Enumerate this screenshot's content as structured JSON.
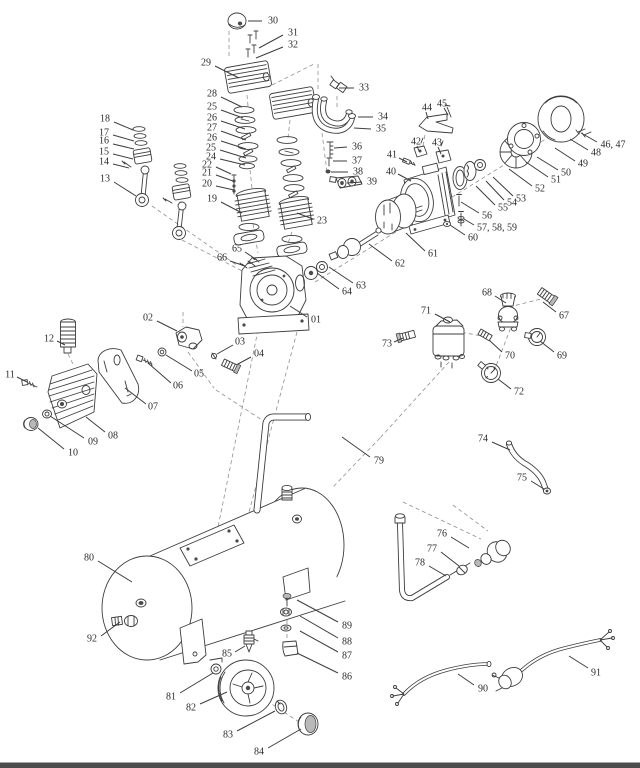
{
  "diagram": {
    "subject": "Air compressor exploded parts diagram",
    "background_color": "#ffffff",
    "line_color": "#3d3d3d",
    "dashed_line_color": "#8f8f8f",
    "label_color": "#2b2b2b",
    "footer_bar_color": "#4c4c4c",
    "label_font_size": 10,
    "callouts": [
      {
        "label": "30",
        "x": 273,
        "y": 21,
        "x1": 262,
        "y1": 21,
        "x2": 248,
        "y2": 21
      },
      {
        "label": "31",
        "x": 293,
        "y": 33,
        "x1": 283,
        "y1": 35,
        "x2": 259,
        "y2": 48
      },
      {
        "label": "32",
        "x": 293,
        "y": 45,
        "x1": 283,
        "y1": 47,
        "x2": 256,
        "y2": 58
      },
      {
        "label": "29",
        "x": 206,
        "y": 63,
        "x1": 215,
        "y1": 66,
        "x2": 239,
        "y2": 78
      },
      {
        "label": "33",
        "x": 364,
        "y": 88,
        "x1": 354,
        "y1": 88,
        "x2": 339,
        "y2": 88
      },
      {
        "label": "34",
        "x": 383,
        "y": 117,
        "x1": 373,
        "y1": 117,
        "x2": 358,
        "y2": 117
      },
      {
        "label": "35",
        "x": 381,
        "y": 129,
        "x1": 371,
        "y1": 129,
        "x2": 354,
        "y2": 128
      },
      {
        "label": "28",
        "x": 212,
        "y": 94,
        "x1": 221,
        "y1": 97,
        "x2": 242,
        "y2": 107
      },
      {
        "label": "25",
        "x": 212,
        "y": 107,
        "x1": 221,
        "y1": 110,
        "x2": 243,
        "y2": 118
      },
      {
        "label": "26",
        "x": 212,
        "y": 118,
        "x1": 221,
        "y1": 121,
        "x2": 245,
        "y2": 129
      },
      {
        "label": "27",
        "x": 212,
        "y": 128,
        "x1": 221,
        "y1": 131,
        "x2": 246,
        "y2": 140
      },
      {
        "label": "26",
        "x": 212,
        "y": 138,
        "x1": 221,
        "y1": 141,
        "x2": 246,
        "y2": 149
      },
      {
        "label": "25",
        "x": 211,
        "y": 148,
        "x1": 220,
        "y1": 150,
        "x2": 246,
        "y2": 158
      },
      {
        "label": "24",
        "x": 211,
        "y": 157,
        "x1": 220,
        "y1": 159,
        "x2": 245,
        "y2": 165
      },
      {
        "label": "22",
        "x": 207,
        "y": 165,
        "x1": 216,
        "y1": 167,
        "x2": 231,
        "y2": 174
      },
      {
        "label": "21",
        "x": 207,
        "y": 173,
        "x1": 216,
        "y1": 175,
        "x2": 233,
        "y2": 181
      },
      {
        "label": "20",
        "x": 207,
        "y": 184,
        "x1": 216,
        "y1": 186,
        "x2": 234,
        "y2": 190
      },
      {
        "label": "19",
        "x": 212,
        "y": 199,
        "x1": 221,
        "y1": 202,
        "x2": 242,
        "y2": 213
      },
      {
        "label": "18",
        "x": 105,
        "y": 119,
        "x1": 114,
        "y1": 122,
        "x2": 133,
        "y2": 130
      },
      {
        "label": "17",
        "x": 104,
        "y": 133,
        "x1": 113,
        "y1": 135,
        "x2": 134,
        "y2": 141
      },
      {
        "label": "16",
        "x": 104,
        "y": 141,
        "x1": 113,
        "y1": 144,
        "x2": 134,
        "y2": 149
      },
      {
        "label": "15",
        "x": 104,
        "y": 152,
        "x1": 113,
        "y1": 154,
        "x2": 133,
        "y2": 159
      },
      {
        "label": "14",
        "x": 104,
        "y": 162,
        "x1": 113,
        "y1": 164,
        "x2": 129,
        "y2": 168
      },
      {
        "label": "13",
        "x": 105,
        "y": 179,
        "x1": 114,
        "y1": 182,
        "x2": 136,
        "y2": 196
      },
      {
        "label": "23",
        "x": 322,
        "y": 221,
        "x1": 313,
        "y1": 219,
        "x2": 297,
        "y2": 213
      },
      {
        "label": "36",
        "x": 357,
        "y": 147,
        "x1": 347,
        "y1": 147,
        "x2": 334,
        "y2": 148
      },
      {
        "label": "37",
        "x": 357,
        "y": 161,
        "x1": 347,
        "y1": 161,
        "x2": 333,
        "y2": 161
      },
      {
        "label": "38",
        "x": 358,
        "y": 172,
        "x1": 348,
        "y1": 172,
        "x2": 331,
        "y2": 172
      },
      {
        "label": "39",
        "x": 372,
        "y": 182,
        "x1": 362,
        "y1": 182,
        "x2": 347,
        "y2": 183
      },
      {
        "label": "44",
        "x": 427,
        "y": 108,
        "x1": 426,
        "y1": 112,
        "x2": 428,
        "y2": 119
      },
      {
        "label": "45",
        "x": 442,
        "y": 104,
        "x1": 444,
        "y1": 108,
        "x2": 448,
        "y2": 115
      },
      {
        "label": "42",
        "x": 416,
        "y": 142,
        "x1": 417,
        "y1": 146,
        "x2": 419,
        "y2": 151
      },
      {
        "label": "43",
        "x": 437,
        "y": 143,
        "x1": 438,
        "y1": 147,
        "x2": 441,
        "y2": 154
      },
      {
        "label": "41",
        "x": 392,
        "y": 155,
        "x1": 399,
        "y1": 158,
        "x2": 407,
        "y2": 162
      },
      {
        "label": "40",
        "x": 391,
        "y": 172,
        "x1": 398,
        "y1": 174,
        "x2": 411,
        "y2": 181
      },
      {
        "label": "46, 47",
        "x": 613,
        "y": 145,
        "x1": 597,
        "y1": 142,
        "x2": 581,
        "y2": 133
      },
      {
        "label": "48",
        "x": 596,
        "y": 153,
        "x1": 588,
        "y1": 150,
        "x2": 570,
        "y2": 139
      },
      {
        "label": "49",
        "x": 583,
        "y": 164,
        "x1": 575,
        "y1": 161,
        "x2": 555,
        "y2": 148
      },
      {
        "label": "50",
        "x": 566,
        "y": 173,
        "x1": 558,
        "y1": 170,
        "x2": 537,
        "y2": 157
      },
      {
        "label": "51",
        "x": 556,
        "y": 180,
        "x1": 548,
        "y1": 177,
        "x2": 526,
        "y2": 162
      },
      {
        "label": "52",
        "x": 540,
        "y": 189,
        "x1": 532,
        "y1": 186,
        "x2": 509,
        "y2": 169
      },
      {
        "label": "53",
        "x": 521,
        "y": 199,
        "x1": 513,
        "y1": 196,
        "x2": 493,
        "y2": 177
      },
      {
        "label": "54",
        "x": 512,
        "y": 203,
        "x1": 504,
        "y1": 200,
        "x2": 486,
        "y2": 181
      },
      {
        "label": "55",
        "x": 503,
        "y": 208,
        "x1": 495,
        "y1": 205,
        "x2": 476,
        "y2": 186
      },
      {
        "label": "56",
        "x": 487,
        "y": 216,
        "x1": 479,
        "y1": 213,
        "x2": 461,
        "y2": 202
      },
      {
        "label": "57, 58, 59",
        "x": 497,
        "y": 228,
        "x1": 474,
        "y1": 225,
        "x2": 464,
        "y2": 219
      },
      {
        "label": "60",
        "x": 473,
        "y": 238,
        "x1": 465,
        "y1": 235,
        "x2": 450,
        "y2": 225
      },
      {
        "label": "61",
        "x": 433,
        "y": 254,
        "x1": 425,
        "y1": 251,
        "x2": 406,
        "y2": 233
      },
      {
        "label": "62",
        "x": 400,
        "y": 264,
        "x1": 392,
        "y1": 261,
        "x2": 369,
        "y2": 244
      },
      {
        "label": "63",
        "x": 361,
        "y": 286,
        "x1": 353,
        "y1": 283,
        "x2": 329,
        "y2": 267
      },
      {
        "label": "64",
        "x": 347,
        "y": 292,
        "x1": 339,
        "y1": 289,
        "x2": 317,
        "y2": 273
      },
      {
        "label": "65",
        "x": 237,
        "y": 249,
        "x1": 245,
        "y1": 252,
        "x2": 257,
        "y2": 260
      },
      {
        "label": "66",
        "x": 222,
        "y": 258,
        "x1": 230,
        "y1": 261,
        "x2": 245,
        "y2": 266
      },
      {
        "label": "01",
        "x": 316,
        "y": 320,
        "x1": 307,
        "y1": 317,
        "x2": 290,
        "y2": 306
      },
      {
        "label": "02",
        "x": 148,
        "y": 318,
        "x1": 157,
        "y1": 321,
        "x2": 177,
        "y2": 331
      },
      {
        "label": "03",
        "x": 240,
        "y": 342,
        "x1": 233,
        "y1": 345,
        "x2": 217,
        "y2": 354
      },
      {
        "label": "04",
        "x": 259,
        "y": 354,
        "x1": 251,
        "y1": 357,
        "x2": 238,
        "y2": 364
      },
      {
        "label": "05",
        "x": 199,
        "y": 374,
        "x1": 192,
        "y1": 371,
        "x2": 166,
        "y2": 355
      },
      {
        "label": "06",
        "x": 178,
        "y": 386,
        "x1": 171,
        "y1": 383,
        "x2": 148,
        "y2": 363
      },
      {
        "label": "07",
        "x": 153,
        "y": 407,
        "x1": 146,
        "y1": 404,
        "x2": 125,
        "y2": 388
      },
      {
        "label": "08",
        "x": 113,
        "y": 436,
        "x1": 105,
        "y1": 432,
        "x2": 86,
        "y2": 417
      },
      {
        "label": "09",
        "x": 93,
        "y": 442,
        "x1": 84,
        "y1": 438,
        "x2": 50,
        "y2": 416
      },
      {
        "label": "10",
        "x": 73,
        "y": 453,
        "x1": 64,
        "y1": 449,
        "x2": 38,
        "y2": 428
      },
      {
        "label": "11",
        "x": 10,
        "y": 375,
        "x1": 17,
        "y1": 377,
        "x2": 27,
        "y2": 382
      },
      {
        "label": "12",
        "x": 49,
        "y": 339,
        "x1": 57,
        "y1": 341,
        "x2": 65,
        "y2": 345
      },
      {
        "label": "67",
        "x": 564,
        "y": 316,
        "x1": 556,
        "y1": 312,
        "x2": 543,
        "y2": 302
      },
      {
        "label": "68",
        "x": 487,
        "y": 293,
        "x1": 495,
        "y1": 296,
        "x2": 506,
        "y2": 303
      },
      {
        "label": "69",
        "x": 562,
        "y": 356,
        "x1": 554,
        "y1": 352,
        "x2": 540,
        "y2": 341
      },
      {
        "label": "70",
        "x": 510,
        "y": 356,
        "x1": 502,
        "y1": 352,
        "x2": 489,
        "y2": 340
      },
      {
        "label": "71",
        "x": 426,
        "y": 311,
        "x1": 435,
        "y1": 314,
        "x2": 450,
        "y2": 322
      },
      {
        "label": "72",
        "x": 519,
        "y": 392,
        "x1": 511,
        "y1": 389,
        "x2": 498,
        "y2": 379
      },
      {
        "label": "73",
        "x": 387,
        "y": 344,
        "x1": 394,
        "y1": 342,
        "x2": 403,
        "y2": 338
      },
      {
        "label": "74",
        "x": 483,
        "y": 439,
        "x1": 492,
        "y1": 442,
        "x2": 510,
        "y2": 450
      },
      {
        "label": "75",
        "x": 522,
        "y": 478,
        "x1": 531,
        "y1": 481,
        "x2": 544,
        "y2": 489
      },
      {
        "label": "76",
        "x": 442,
        "y": 534,
        "x1": 451,
        "y1": 537,
        "x2": 469,
        "y2": 548
      },
      {
        "label": "77",
        "x": 432,
        "y": 549,
        "x1": 441,
        "y1": 552,
        "x2": 459,
        "y2": 566
      },
      {
        "label": "78",
        "x": 420,
        "y": 563,
        "x1": 429,
        "y1": 566,
        "x2": 446,
        "y2": 576
      },
      {
        "label": "79",
        "x": 379,
        "y": 461,
        "x1": 370,
        "y1": 457,
        "x2": 342,
        "y2": 437
      },
      {
        "label": "80",
        "x": 89,
        "y": 558,
        "x1": 98,
        "y1": 561,
        "x2": 132,
        "y2": 582
      },
      {
        "label": "92",
        "x": 92,
        "y": 639,
        "x1": 101,
        "y1": 636,
        "x2": 120,
        "y2": 622
      },
      {
        "label": "85",
        "x": 227,
        "y": 654,
        "x1": 235,
        "y1": 652,
        "x2": 245,
        "y2": 646
      },
      {
        "label": "81",
        "x": 171,
        "y": 697,
        "x1": 180,
        "y1": 693,
        "x2": 213,
        "y2": 673
      },
      {
        "label": "82",
        "x": 191,
        "y": 708,
        "x1": 200,
        "y1": 704,
        "x2": 227,
        "y2": 692
      },
      {
        "label": "83",
        "x": 228,
        "y": 735,
        "x1": 237,
        "y1": 731,
        "x2": 275,
        "y2": 711
      },
      {
        "label": "84",
        "x": 259,
        "y": 752,
        "x1": 268,
        "y1": 748,
        "x2": 301,
        "y2": 729
      },
      {
        "label": "86",
        "x": 347,
        "y": 677,
        "x1": 338,
        "y1": 673,
        "x2": 297,
        "y2": 653
      },
      {
        "label": "87",
        "x": 347,
        "y": 656,
        "x1": 338,
        "y1": 652,
        "x2": 300,
        "y2": 631
      },
      {
        "label": "88",
        "x": 347,
        "y": 642,
        "x1": 338,
        "y1": 638,
        "x2": 300,
        "y2": 616
      },
      {
        "label": "89",
        "x": 347,
        "y": 626,
        "x1": 338,
        "y1": 622,
        "x2": 297,
        "y2": 600
      },
      {
        "label": "90",
        "x": 483,
        "y": 689,
        "x1": 474,
        "y1": 685,
        "x2": 458,
        "y2": 674
      },
      {
        "label": "91",
        "x": 596,
        "y": 673,
        "x1": 588,
        "y1": 668,
        "x2": 569,
        "y2": 656
      }
    ]
  }
}
